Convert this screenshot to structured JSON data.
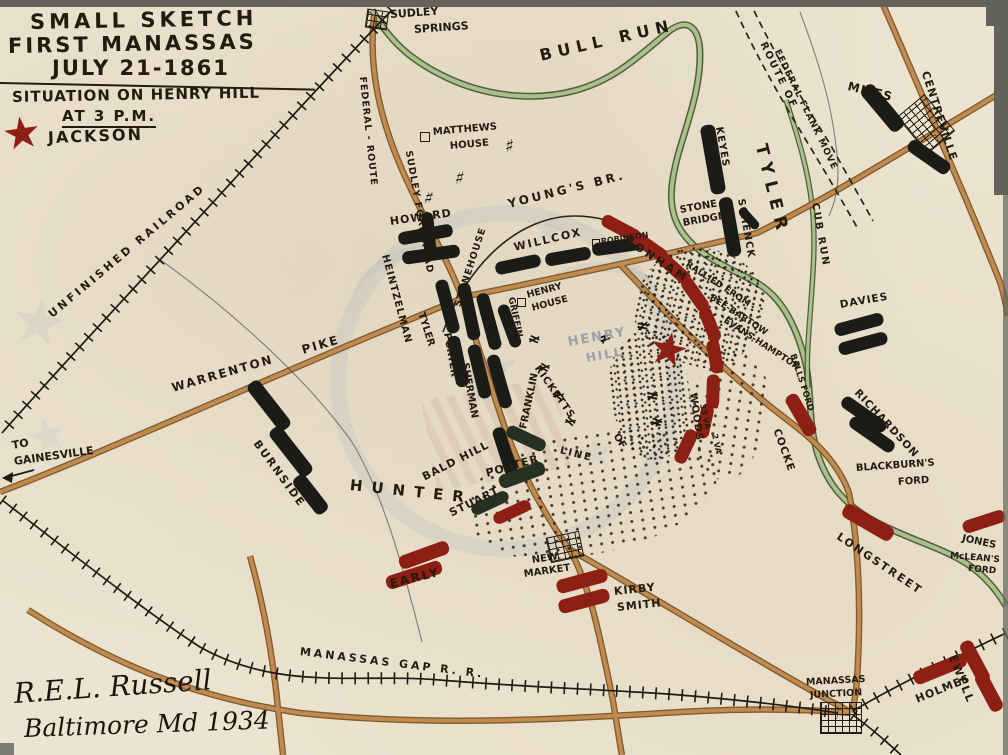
{
  "map_title": "Small Sketch First Manassas July 21-1861 — Situation on Henry Hill at 3 P.M.",
  "labels": {
    "title_line1": "SMALL SKETCH",
    "title_line2": "FIRST MANASSAS",
    "title_line3": "JULY 21-1861",
    "subtitle_line1": "SITUATION ON HENRY HILL",
    "subtitle_line2": "AT 3 P.M.",
    "legend_jackson": "JACKSON",
    "sudley_1": "SUDLEY",
    "sudley_2": "SPRINGS",
    "bull_run": "BULL RUN",
    "cub_run": "CUB RUN",
    "route_of": "ROUTE OF",
    "federal_flank_move": "FEDERAL FLANK MOVE",
    "federal_route": "FEDERAL - ROUTE",
    "sudley_ford_road": "SUDLEY FORD ROAD",
    "unfinished_railroad": "UNFINISHED RAILROAD",
    "warrenton": "WARRENTON",
    "pike": "PIKE",
    "to": "TO",
    "gainesville": "GAINESVILLE",
    "matthews_1": "MATTHEWS",
    "matthews_2": "HOUSE",
    "youngs_br": "YOUNG'S BR.",
    "stonehouse": "STONEHOUSE",
    "stone_bridge_1": "STONE",
    "stone_bridge_2": "BRIDGE",
    "robinson": "ROBINSON",
    "henry_house_1": "HENRY",
    "henry_house_2": "HOUSE",
    "henry_hill_1": "HENRY",
    "henry_hill_2": "HILL",
    "bald_hill": "BALD HILL",
    "line_1": "LINE",
    "line_2": "OF",
    "line_3": "WOODS",
    "new_market_1": "NEW",
    "new_market_2": "MARKET",
    "manassas_gap_rr": "MANASSAS GAP R. R.",
    "manassas_jct_1": "MANASSAS",
    "manassas_jct_2": "JUNCTION",
    "blackburns_1": "BLACKBURN'S",
    "blackburns_2": "FORD",
    "mcleans_1": "McLEAN'S",
    "mcleans_2": "FORD",
    "balls_ford": "BALLS FORD",
    "centreville": "CENTREVILLE",
    "miles": "MILES",
    "tyler": "TYLER",
    "tyler_center": "TYLER",
    "keyes": "KEYES",
    "schenck": "SCHENCK",
    "howard": "HOWARD",
    "heintzelman": "HEINTZELMAN",
    "willcox": "WILLCOX",
    "franklin": "FRANKLIN",
    "sherman": "SHERMAN",
    "porter_vertical": "PORTER",
    "griffin": "GRIFFIN",
    "ricketts": "RICKETTS",
    "burnside": "BURNSIDE",
    "hunter": "HUNTER",
    "porter": "PORTER",
    "davies": "DAVIES",
    "richardson": "RICHARDSON",
    "bonham": "BONHAM",
    "rallied_1": "RALLIED FROM",
    "rallied_2": "BEE-BARTOW",
    "rallied_3": "EVANS-HAMPTON",
    "cocke": "COCKE",
    "stuart": "STUART",
    "early": "EARLY",
    "kirby_1": "KIRBY",
    "kirby_2": "SMITH",
    "longstreet": "LONGSTREET",
    "jones": "JONES",
    "ewell": "EWELL",
    "holmes": "HOLMES",
    "va33": "33 VA",
    "va2": "2 VA",
    "signature_line1": "R.E.L. Russell",
    "signature_line2": "Baltimore Md 1934"
  },
  "symbols": {
    "artillery": "≠",
    "hay": "♯",
    "star": "★",
    "arrow_left": "←"
  },
  "colors": {
    "paper": "#ece4d0",
    "ink": "#241a0e",
    "union_bar": "#1b1b18",
    "confederate_bar": "#8e1f14",
    "river": "#a9c18b",
    "road": "#c08b50",
    "star_red": "#8e1f14",
    "watermark": "#8ca0bc",
    "henry_hill_gray": "#99a0a8"
  }
}
